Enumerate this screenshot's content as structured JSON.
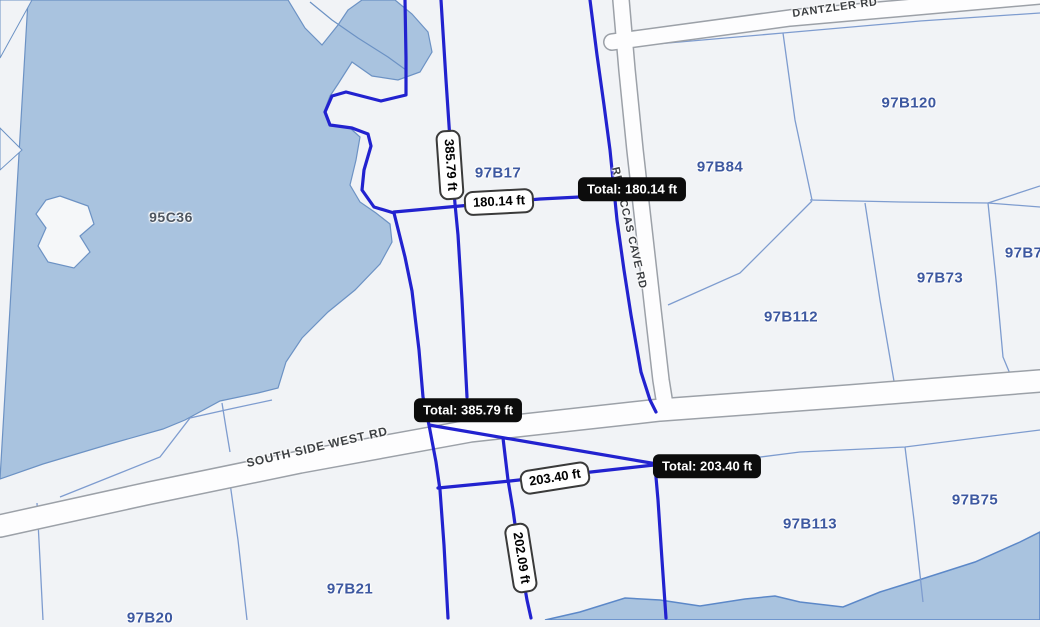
{
  "map": {
    "water_label": {
      "text": "95C36"
    },
    "parcel_labels": [
      {
        "text": "97B17"
      },
      {
        "text": "97B84"
      },
      {
        "text": "97B120"
      },
      {
        "text": "97B73"
      },
      {
        "text": "97B74"
      },
      {
        "text": "97B112"
      },
      {
        "text": "97B75"
      },
      {
        "text": "97B113"
      },
      {
        "text": "97B21"
      },
      {
        "text": "97B20"
      }
    ],
    "road_labels": [
      {
        "text": "DANTZLER RD"
      },
      {
        "text": "SOUTH SIDE WEST RD"
      },
      {
        "text": "REBECCAS CAVE RD"
      }
    ],
    "measurement": {
      "segments": [
        {
          "text": "385.79 ft"
        },
        {
          "text": "180.14 ft"
        },
        {
          "text": "203.40 ft"
        },
        {
          "text": "202.09 ft"
        }
      ],
      "totals": [
        {
          "text": "Total: 180.14 ft"
        },
        {
          "text": "Total: 385.79 ft"
        },
        {
          "text": "Total: 203.40 ft"
        }
      ]
    },
    "colors": {
      "water": "#a9c3df",
      "land": "#f1f3f6",
      "parcel_line": "#7e9ccf",
      "highlight_line": "#2222cf",
      "parcel_label": "#3d58a0",
      "road_fill": "#fdfdfe",
      "road_casing": "#9ca1a8",
      "total_badge_bg": "#0c0c0c",
      "segment_badge_bg": "#ffffff"
    }
  }
}
